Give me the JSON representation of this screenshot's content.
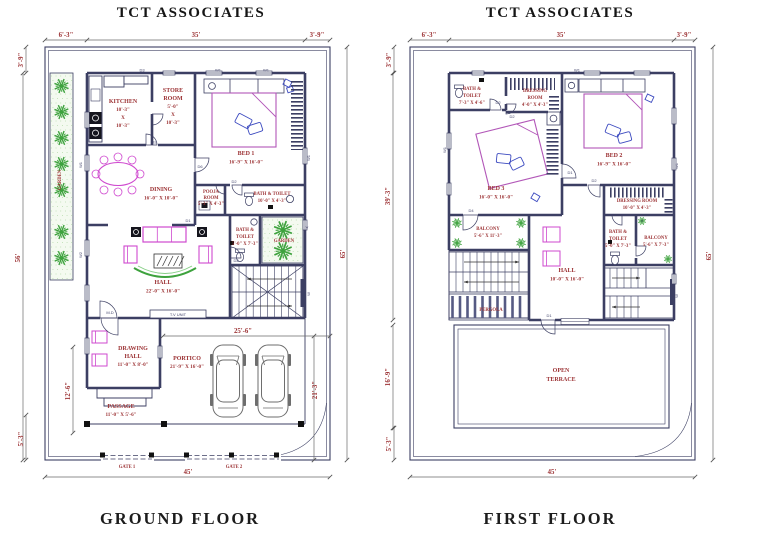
{
  "company": "TCT ASSOCIATES",
  "colors": {
    "wall": "#3c3f63",
    "label": "#9c3234",
    "furniture": "#cf49cf",
    "bed": "#b257b8",
    "accent_blue": "#3d4bc0",
    "plant_green": "#3da23d"
  },
  "ground_floor": {
    "caption": "GROUND FLOOR",
    "dims": {
      "top_left": "6'-3\"",
      "top_mid": "35'",
      "top_right": "3'-9\"",
      "left_top": "3'-9\"",
      "left_side": "56'",
      "right_side": "65'",
      "bottom": "45'",
      "portico_w": "25'-6\"",
      "portico_h": "21'-3\"",
      "passage_h": "12'-6\"",
      "corner": "5'-3\""
    },
    "rooms": {
      "kitchen": {
        "name": "KITCHEN",
        "w": "10'-3\"",
        "x": "X",
        "h": "10'-3\""
      },
      "store": {
        "n1": "STORE",
        "n2": "ROOM",
        "w": "5'-0\"",
        "x": "X",
        "h": "10'-3\""
      },
      "bed1": {
        "name": "BED 1",
        "size": "16'-9\" X 16'-0\""
      },
      "dining": {
        "name": "DINING",
        "size": "16'-0\" X 10'-0\""
      },
      "pooja": {
        "n1": "POOJA",
        "n2": "ROOM",
        "size": "5'-3\" X 4'-3\""
      },
      "bath1": {
        "name": "BATH & TOILET",
        "size": "10'-0\" X 4'-3\""
      },
      "bath2": {
        "n1": "BATH &",
        "n2": "TOILET",
        "size": "5'-0\" X 7'-3\""
      },
      "garden_side": "GARDEN",
      "garden_strip": "GARDEN",
      "hall": {
        "name": "HALL",
        "size": "22'-0\" X 16'-0\""
      },
      "tv_unit": "T.V UNIT",
      "drawing": {
        "n1": "DRAWING",
        "n2": "HALL",
        "size": "11'-0\" X 8'-0\""
      },
      "portico": {
        "name": "PORTICO",
        "size": "21'-9\" X 16'-0\""
      },
      "passage": {
        "name": "PASSAGE",
        "size": "11'-0\" X 5'-6\""
      },
      "gate1": "GATE 1",
      "gate2": "GATE 2"
    },
    "tags": {
      "w1": "W1",
      "w2": "W2",
      "d1": "D1",
      "d2": "D2",
      "d3": "D3",
      "d4": "D4",
      "d6": "D6",
      "md": "M.D",
      "v": "V",
      "w": "W"
    }
  },
  "first_floor": {
    "caption": "FIRST FLOOR",
    "dims": {
      "top_left": "6'-3\"",
      "top_mid": "35'",
      "top_right": "3'-9\"",
      "left_top": "3'-9\"",
      "left_upper": "39'-3\"",
      "left_lower": "16'-9\"",
      "left_bottom": "5'-3\"",
      "right_side": "65'",
      "bottom": "45'"
    },
    "rooms": {
      "bath3": {
        "n1": "BATH &",
        "n2": "TOILET",
        "size": "7'-3\" X 4'-6\""
      },
      "dress1": {
        "n1": "DRESSING",
        "n2": "ROOM",
        "size": "4'-0\" X 4'-3\""
      },
      "bed2": {
        "name": "BED 2",
        "size": "16'-9\" X 16'-0\""
      },
      "bed3": {
        "name": "BED 3",
        "size": "16'-0\" X 16'-0\""
      },
      "dress2": {
        "name": "DRESSING ROOM",
        "size": "10'-0\" X 4'-3\""
      },
      "bath4": {
        "n1": "BATH &",
        "n2": "TOILET",
        "size": "5'-0\" X 7'-3\""
      },
      "balcony1": {
        "name": "BALCONY",
        "size": "5'-6\" X 11'-3\""
      },
      "balcony2": {
        "name": "BALCONY",
        "size": "5'-6\" X 7'-3\""
      },
      "hall": {
        "name": "HALL",
        "size": "10'-0\" X 16'-0\""
      },
      "pergola": "PERGOLA",
      "terrace": {
        "n1": "OPEN",
        "n2": "TERRACE"
      }
    },
    "tags": {
      "w1": "W1",
      "d1": "D1",
      "d2": "D2",
      "d4": "D4",
      "v": "V",
      "w": "W"
    }
  }
}
